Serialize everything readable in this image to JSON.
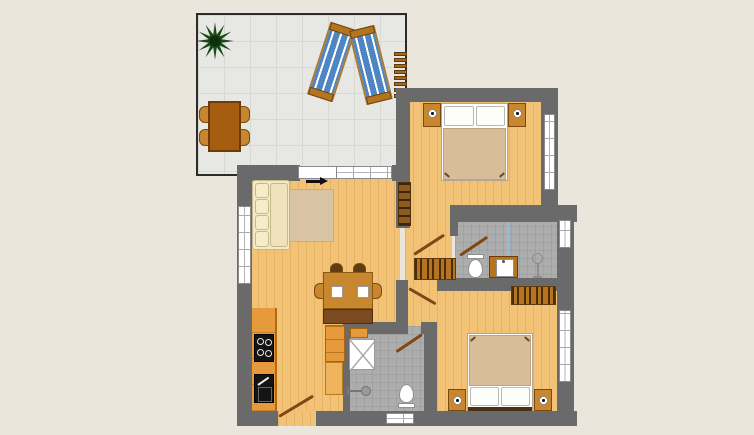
{
  "title": "apartment-floor-plan",
  "palette": {
    "bg": "#EAE6DB",
    "wall": "#6A6A6A",
    "floor-wood": "#F2C377",
    "floor-terrace": "#E7E7E3",
    "floor-bath": "#ADADAD",
    "furn-brown": "#B5741F",
    "furn-brown2": "#C8862F",
    "furn-dark": "#7B4A21",
    "bed": "#D9BD9A",
    "sofa": "#F3E9C7",
    "rug": "#D8C3A2",
    "lounger-blue": "#4E86C4",
    "plant-green": "#1B4A17",
    "door": "#7D4716",
    "kitchen": "#E79A3B",
    "terrace-table": "#A55C0F"
  },
  "rooms": [
    {
      "id": "terrace",
      "furniture": [
        "potted-plant",
        "sun-lounger",
        "sun-lounger",
        "outdoor-table",
        "outdoor-chair x4",
        "ladder"
      ]
    },
    {
      "id": "living-dining-room",
      "furniture": [
        "corner-sofa",
        "rug",
        "entrance-arrow",
        "bookshelf",
        "dining-table",
        "bench",
        "chair x4",
        "plate x2"
      ]
    },
    {
      "id": "kitchen",
      "furniture": [
        "counter",
        "cooktop",
        "sink",
        "cabinet-tower"
      ]
    },
    {
      "id": "bedroom-top",
      "furniture": [
        "double-bed",
        "pillow x2",
        "nightstand x2",
        "lamp x2",
        "window"
      ]
    },
    {
      "id": "bathroom-top",
      "furniture": [
        "toilet",
        "vanity-sink",
        "shower-fixture",
        "glass-partition",
        "window"
      ]
    },
    {
      "id": "hallway",
      "furniture": [
        "wardrobe",
        "door x3"
      ]
    },
    {
      "id": "bedroom-bottom",
      "furniture": [
        "double-bed",
        "pillow x2",
        "nightstand x2",
        "lamp x2",
        "wardrobe",
        "window"
      ]
    },
    {
      "id": "bathroom-bottom",
      "furniture": [
        "shower-tray",
        "shower-head",
        "toilet",
        "window",
        "door"
      ]
    }
  ],
  "doors": [
    "entrance-door",
    "terrace-door",
    "bedroom-top-door",
    "bathroom-top-door",
    "bedroom-bottom-door",
    "bathroom-bottom-door"
  ],
  "windows": [
    "living-left-window",
    "living-top-window",
    "bedroom-top-window",
    "bathroom-top-window",
    "bedroom-bottom-window",
    "bathroom-bottom-window"
  ]
}
